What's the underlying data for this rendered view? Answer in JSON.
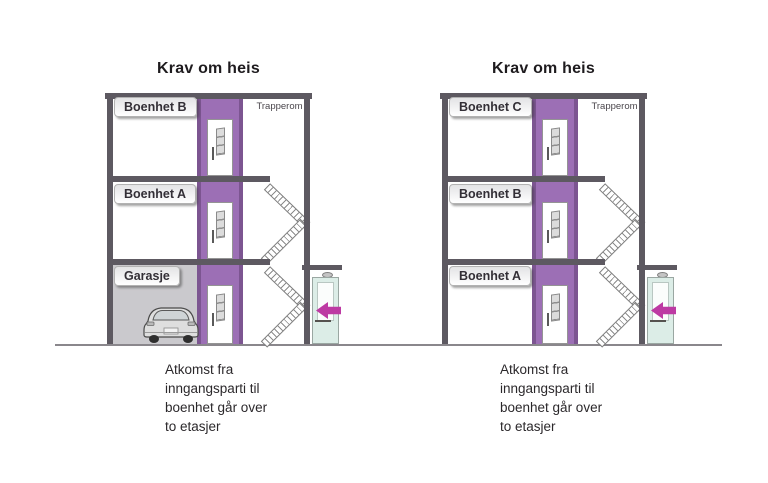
{
  "diagrams": [
    {
      "title": "Krav om heis",
      "stairwell_label": "Trapperom",
      "floor_labels": [
        "Boenhet B",
        "Boenhet A",
        "Garasje"
      ],
      "caption_lines": [
        "Atkomst fra",
        "inngangsparti til",
        "boenhet går over",
        "to etasjer"
      ],
      "has_garage_with_car": true
    },
    {
      "title": "Krav om heis",
      "stairwell_label": "Trapperom",
      "floor_labels": [
        "Boenhet C",
        "Boenhet B",
        "Boenhet A"
      ],
      "caption_lines": [
        "Atkomst fra",
        "inngangsparti til",
        "boenhet går over",
        "to etasjer"
      ],
      "has_garage_with_car": false
    }
  ],
  "icons": {
    "entrance_arrow": "left-arrow",
    "car": "car-rear-view",
    "lamp": "entrance-lamp"
  },
  "colors": {
    "wall": "#5d5961",
    "shaft": "#9c6fb5",
    "shaft_edge": "#7c5591",
    "garage_fill": "#cac9cd",
    "arrow": "#bd3aa3",
    "entrance_door": "#dcede7",
    "ground": "#8a878c"
  }
}
